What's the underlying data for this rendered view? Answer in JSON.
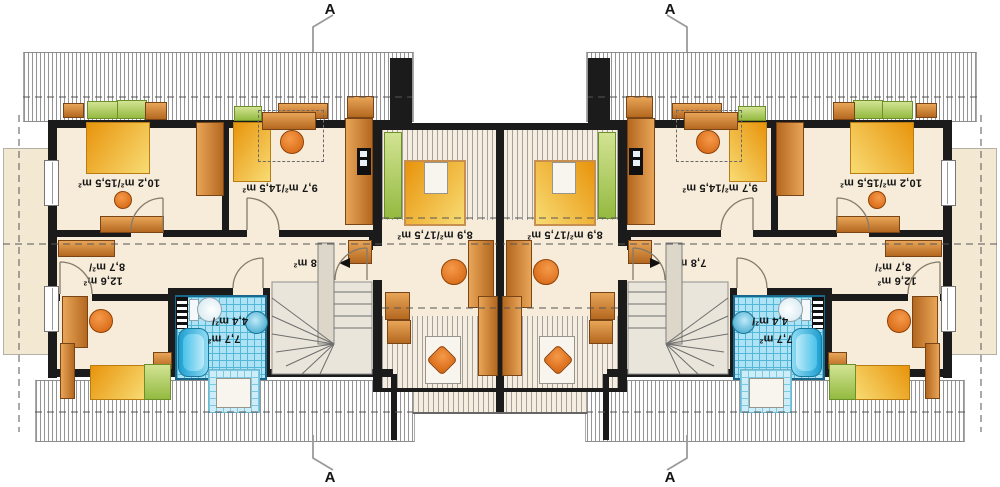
{
  "section_marker": {
    "label": "A"
  },
  "rooms": {
    "bedroom_large": {
      "area_label": "10,2 m²/15,5 m²"
    },
    "bedroom_mid": {
      "area_label": "9,7 m²/14,5 m²"
    },
    "center_room": {
      "area_label": "8,9 m²/17,5 m²"
    },
    "bedroom_small": {
      "area_label_line1": "8,7 m²/",
      "area_label_line2": "12,6 m²"
    },
    "bathroom": {
      "area_label_line1": "4,4 m²/",
      "area_label_line2": "7,7 m²"
    },
    "hall": {
      "area_label": "7,8 m²"
    },
    "stairs": {
      "area_label": "2,1 m²"
    }
  },
  "colors": {
    "wall": "#1b1b1b",
    "floor": "#f6ecd9",
    "roof_hatch_line": "#949494",
    "tile_blue": "#aee3f5",
    "tile_grid": "#53b7d8",
    "furniture_brown": "#c97a33",
    "bed_gold": "#f0a91f",
    "furniture_green": "#a9c862",
    "chair_orange": "#e0700f",
    "stairs_gray": "#eae5da"
  }
}
